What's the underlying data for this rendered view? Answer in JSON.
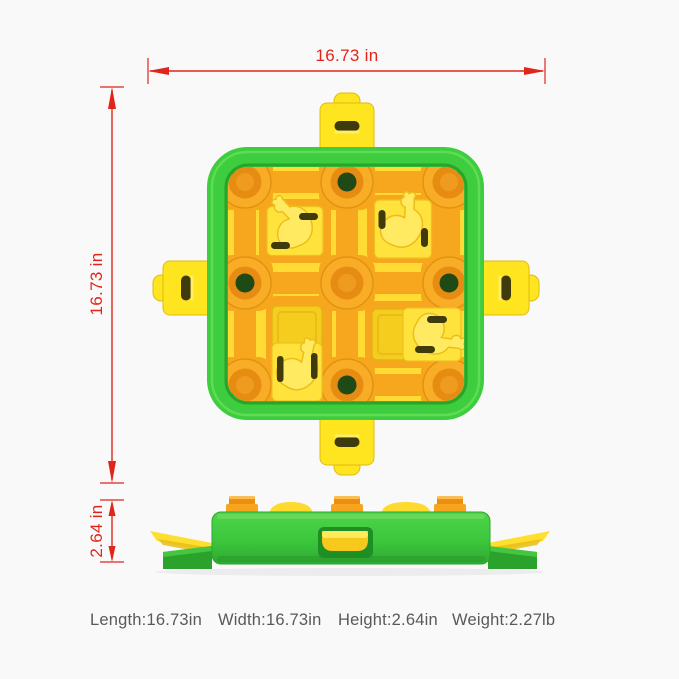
{
  "diagram": {
    "width_dim": "16.73 in",
    "height_dim": "16.73 in",
    "depth_dim": "2.64 in"
  },
  "specs": {
    "length": "Length:16.73in",
    "width": "Width:16.73in",
    "height": "Height:2.64in",
    "weight": "Weight:2.27lb"
  },
  "colors": {
    "dimension_red": "#e0261a",
    "spec_text_gray": "#595959",
    "toy_green": "#3ecd3e",
    "toy_green_dark": "#2ba42b",
    "toy_yellow": "#ffdf33",
    "toy_yellow_tab": "#ffe520",
    "toy_orange": "#f7a71e",
    "toy_orange_dark": "#e68c12",
    "well_hole_dark_green": "#1f4a16",
    "slot_dark": "#3f3b0d",
    "background": "#f9f9f9"
  }
}
